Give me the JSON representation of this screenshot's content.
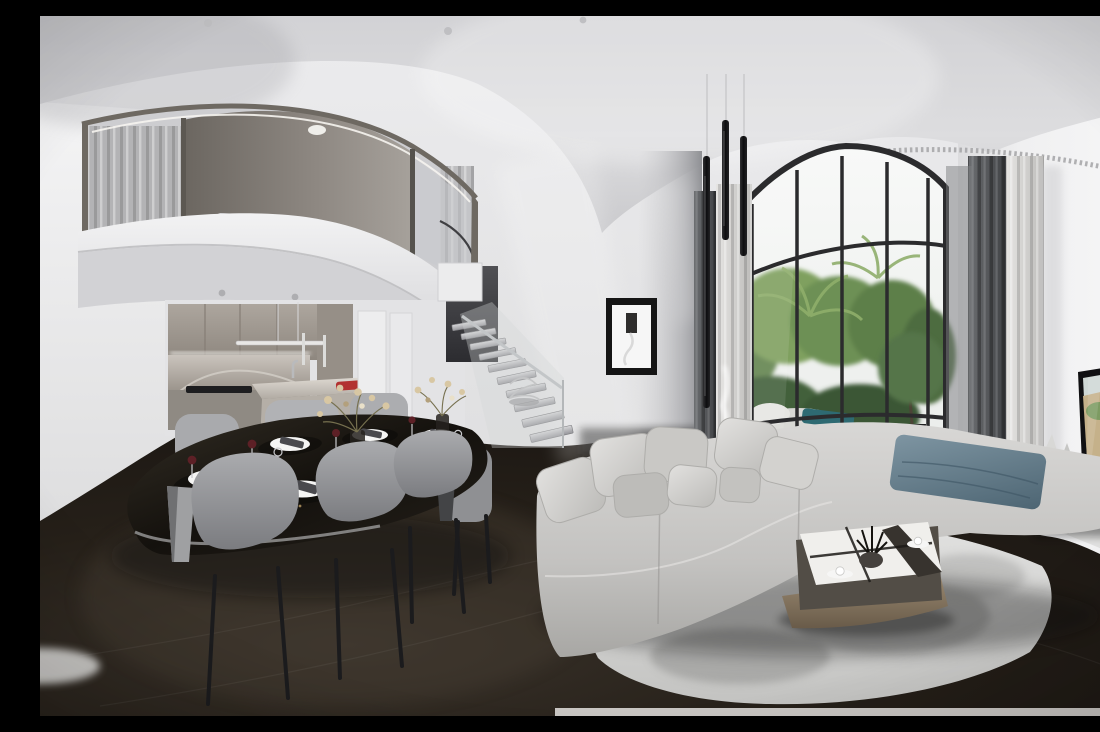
{
  "scene": {
    "kind": "equirectangular-360-interior-render",
    "rooms": [
      "mezzanine-loft",
      "kitchen",
      "dining-area",
      "floating-staircase",
      "living-area",
      "terrace-garden-view",
      "tv-wall"
    ],
    "objects": [
      "curved mezzanine with glass balustrade and gray curtains",
      "concrete mezzanine ceiling with downlight",
      "gray wood kitchen cabinets with marble backsplash and island",
      "red decor object on kitchen island",
      "linear pendant light over island",
      "black oval dining table set for five with white plates, dark napkins, wine glasses and gold dried-flower arrangements",
      "gray upholstered dining chairs with black legs",
      "floating stair treads with glass railing and wire sculpture",
      "black framed minimalist artwork on gray wall",
      "three black tube pendant lights",
      "arched floor-to-ceiling window with black mullions",
      "tropical palms and shrubs on stone terrace with potted tree and teal towel",
      "dark gray and sheer curtains",
      "light gray sectional sofa with pillows and slate-blue throw",
      "two-tier coffee table with glossy top, wooden shelf, plant and two coffee cups",
      "marbled gray area rug",
      "wall-mounted TV showing coastal cliffs and turquoise sea",
      "white curved floating media console with decor",
      "dark stained oak floor"
    ]
  },
  "palette": {
    "ceiling": "#d6d6d9",
    "wallLeft": "#f1f1f2",
    "wallCenter": "#e7e7e9",
    "wallRight": "#f2f2f3",
    "floor": "#241f1b",
    "mezzFrame": "#6e6962",
    "fascia": "#e9e9ea",
    "concrete": "#7d7771",
    "curtainMezz": "#b4b4b6",
    "cabinet": "#a49d95",
    "backsplash": "#b7b1aa",
    "islandTop": "#d6d1ca",
    "redAccent": "#b23230",
    "tableTop": "#17130f",
    "chair": "#96979b",
    "plate": "#f5f5f4",
    "napkin": "#4a4a4e",
    "flower": "#d8c7a3",
    "wine": "#5d2026",
    "stepGray": "#c6c6c9",
    "glass": "#cfd3d6",
    "artFrame": "#151515",
    "mullion": "#2b2b2d",
    "sky": "#f6f8f7",
    "foliage": "#5d7c49",
    "terrace": "#b6bab6",
    "towel": "#2e6a72",
    "curtainDark": "#55575a",
    "curtainSheer": "#d7d6d4",
    "sofa": "#c7c6c4",
    "pillow": "#dad9d7",
    "throw": "#64808f",
    "rug": "#dadad9",
    "rugBlotch": "#9a9a99",
    "coffeeWood": "#8a7a64",
    "tvFrame": "#101012",
    "tvSea": "#4f9aa8",
    "tvCliff": "#c5b18a",
    "console": "#ebebea",
    "pendantTube": "#17171a",
    "led": "#f6f4ef"
  }
}
